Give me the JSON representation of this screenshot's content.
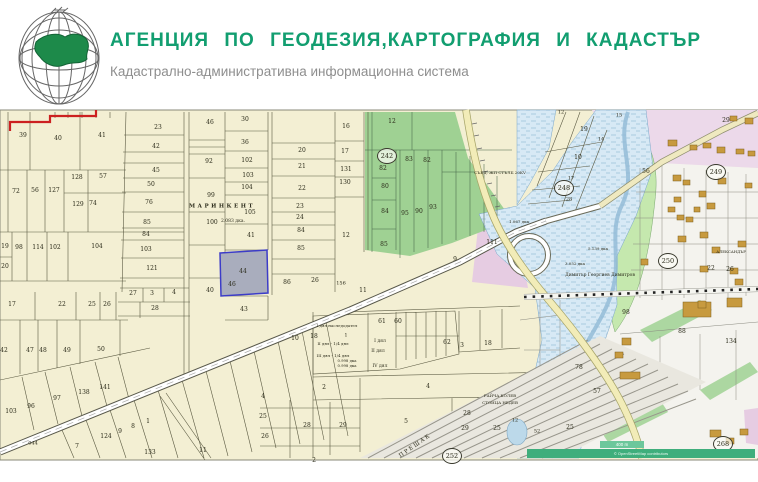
{
  "header": {
    "title": "АГЕНЦИЯ ПО ГЕОДЕЗИЯ,КАРТОГРАФИЯ И КАДАСТЪР",
    "subtitle": "Кадастрално-административна информационна система"
  },
  "map": {
    "highlighted_parcel": {
      "label": "44"
    },
    "sheets": [
      {
        "label": "242",
        "x": 387,
        "y": 156
      },
      {
        "label": "248",
        "x": 564,
        "y": 188
      },
      {
        "label": "249",
        "x": 716,
        "y": 172
      },
      {
        "label": "250",
        "x": 668,
        "y": 261
      },
      {
        "label": "252",
        "x": 452,
        "y": 456
      },
      {
        "label": "268",
        "x": 723,
        "y": 444
      }
    ],
    "attribution": {
      "scale": "400 m",
      "text": "© OpenStreetMap contributors"
    },
    "colors": {
      "brand_green": "#129e70",
      "parcel_fill": "#f3efd3",
      "zone_green": "#9fd193",
      "river_blue": "#d7e9f5",
      "road_yellow": "#f2ecb8",
      "highlight_fill": "#a9adbd",
      "highlight_border": "#3c3cc8",
      "red_boundary": "#cc2020",
      "attribution_teal": "#3fae7c"
    },
    "labels": [
      {
        "t": "39",
        "x": 23,
        "y": 136
      },
      {
        "t": "40",
        "x": 58,
        "y": 139
      },
      {
        "t": "41",
        "x": 102,
        "y": 136
      },
      {
        "t": "72",
        "x": 16,
        "y": 192
      },
      {
        "t": "56",
        "x": 35,
        "y": 191
      },
      {
        "t": "127",
        "x": 54,
        "y": 191
      },
      {
        "t": "128",
        "x": 77,
        "y": 178
      },
      {
        "t": "57",
        "x": 103,
        "y": 177
      },
      {
        "t": "129",
        "x": 78,
        "y": 205
      },
      {
        "t": "74",
        "x": 93,
        "y": 204
      },
      {
        "t": "19",
        "x": 5,
        "y": 247
      },
      {
        "t": "98",
        "x": 19,
        "y": 248
      },
      {
        "t": "114",
        "x": 38,
        "y": 248
      },
      {
        "t": "102",
        "x": 55,
        "y": 248
      },
      {
        "t": "104",
        "x": 97,
        "y": 247
      },
      {
        "t": "20",
        "x": 5,
        "y": 267
      },
      {
        "t": "17",
        "x": 12,
        "y": 305
      },
      {
        "t": "22",
        "x": 62,
        "y": 305
      },
      {
        "t": "25",
        "x": 92,
        "y": 305
      },
      {
        "t": "26",
        "x": 107,
        "y": 305
      },
      {
        "t": "42",
        "x": 4,
        "y": 351
      },
      {
        "t": "47",
        "x": 30,
        "y": 351
      },
      {
        "t": "48",
        "x": 43,
        "y": 351
      },
      {
        "t": "49",
        "x": 67,
        "y": 351
      },
      {
        "t": "50",
        "x": 101,
        "y": 350
      },
      {
        "t": "103",
        "x": 11,
        "y": 412
      },
      {
        "t": "96",
        "x": 31,
        "y": 407
      },
      {
        "t": "97",
        "x": 57,
        "y": 399
      },
      {
        "t": "138",
        "x": 84,
        "y": 393
      },
      {
        "t": "141",
        "x": 105,
        "y": 388
      },
      {
        "t": "7",
        "x": 77,
        "y": 447
      },
      {
        "t": "044",
        "x": 33,
        "y": 444,
        "s": 5
      },
      {
        "t": "23",
        "x": 158,
        "y": 128
      },
      {
        "t": "42",
        "x": 156,
        "y": 147
      },
      {
        "t": "45",
        "x": 156,
        "y": 171
      },
      {
        "t": "50",
        "x": 151,
        "y": 185
      },
      {
        "t": "76",
        "x": 149,
        "y": 203
      },
      {
        "t": "85",
        "x": 147,
        "y": 223
      },
      {
        "t": "84",
        "x": 146,
        "y": 235
      },
      {
        "t": "103",
        "x": 146,
        "y": 250
      },
      {
        "t": "121",
        "x": 152,
        "y": 269
      },
      {
        "t": "27",
        "x": 133,
        "y": 294
      },
      {
        "t": "3",
        "x": 152,
        "y": 294
      },
      {
        "t": "4",
        "x": 174,
        "y": 293
      },
      {
        "t": "28",
        "x": 155,
        "y": 309
      },
      {
        "t": "46",
        "x": 210,
        "y": 123
      },
      {
        "t": "92",
        "x": 209,
        "y": 162
      },
      {
        "t": "99",
        "x": 211,
        "y": 196
      },
      {
        "t": "100",
        "x": 212,
        "y": 223
      },
      {
        "t": "40",
        "x": 210,
        "y": 291
      },
      {
        "t": "30",
        "x": 245,
        "y": 120
      },
      {
        "t": "36",
        "x": 245,
        "y": 143
      },
      {
        "t": "102",
        "x": 247,
        "y": 161
      },
      {
        "t": "103",
        "x": 248,
        "y": 176
      },
      {
        "t": "104",
        "x": 247,
        "y": 188
      },
      {
        "t": "МАРИНКЕНТ",
        "x": 222,
        "y": 207,
        "s": 5.5,
        "ls": 2.5,
        "b": true
      },
      {
        "t": "105",
        "x": 250,
        "y": 213
      },
      {
        "t": "2.083 дка.",
        "x": 233,
        "y": 222,
        "s": 4.5
      },
      {
        "t": "41",
        "x": 251,
        "y": 236
      },
      {
        "t": "44",
        "x": 243,
        "y": 272
      },
      {
        "t": "43",
        "x": 244,
        "y": 310
      },
      {
        "t": "46",
        "x": 232,
        "y": 285
      },
      {
        "t": "20",
        "x": 302,
        "y": 151
      },
      {
        "t": "21",
        "x": 302,
        "y": 167
      },
      {
        "t": "22",
        "x": 302,
        "y": 189
      },
      {
        "t": "23",
        "x": 300,
        "y": 207
      },
      {
        "t": "24",
        "x": 300,
        "y": 218
      },
      {
        "t": "84",
        "x": 301,
        "y": 231
      },
      {
        "t": "85",
        "x": 301,
        "y": 249
      },
      {
        "t": "86",
        "x": 287,
        "y": 283
      },
      {
        "t": "26",
        "x": 315,
        "y": 281
      },
      {
        "t": "16",
        "x": 346,
        "y": 127
      },
      {
        "t": "17",
        "x": 345,
        "y": 152
      },
      {
        "t": "131",
        "x": 346,
        "y": 170
      },
      {
        "t": "130",
        "x": 345,
        "y": 183
      },
      {
        "t": "12",
        "x": 346,
        "y": 236
      },
      {
        "t": "156",
        "x": 341,
        "y": 284,
        "s": 5
      },
      {
        "t": "11",
        "x": 363,
        "y": 291
      },
      {
        "t": "12",
        "x": 392,
        "y": 122
      },
      {
        "t": "83",
        "x": 409,
        "y": 160
      },
      {
        "t": "82",
        "x": 427,
        "y": 161
      },
      {
        "t": "82",
        "x": 383,
        "y": 169
      },
      {
        "t": "80",
        "x": 385,
        "y": 187
      },
      {
        "t": "84",
        "x": 385,
        "y": 212
      },
      {
        "t": "85",
        "x": 384,
        "y": 245
      },
      {
        "t": "95",
        "x": 405,
        "y": 214
      },
      {
        "t": "90",
        "x": 419,
        "y": 212
      },
      {
        "t": "93",
        "x": 433,
        "y": 208
      },
      {
        "t": "12",
        "x": 561,
        "y": 113,
        "s": 5
      },
      {
        "t": "15",
        "x": 619,
        "y": 116,
        "s": 5
      },
      {
        "t": "19",
        "x": 584,
        "y": 130
      },
      {
        "t": "14",
        "x": 601,
        "y": 140,
        "s": 5
      },
      {
        "t": "10",
        "x": 578,
        "y": 158
      },
      {
        "t": "17",
        "x": 571,
        "y": 179,
        "s": 5
      },
      {
        "t": "28",
        "x": 569,
        "y": 200,
        "s": 5
      },
      {
        "t": "29",
        "x": 726,
        "y": 121
      },
      {
        "t": "56",
        "x": 646,
        "y": 172
      },
      {
        "t": "СЪЕД. ЖП СТЪЛБ 20КV",
        "x": 500,
        "y": 173,
        "s": 4
      },
      {
        "t": "111",
        "x": 492,
        "y": 243
      },
      {
        "t": "9",
        "x": 455,
        "y": 260
      },
      {
        "t": "1.067 дка",
        "x": 519,
        "y": 222,
        "s": 4
      },
      {
        "t": "5.139 дка",
        "x": 598,
        "y": 249,
        "s": 4
      },
      {
        "t": "3.052 дка",
        "x": 575,
        "y": 264,
        "s": 4
      },
      {
        "t": "Димитър Георгиев Димитров",
        "x": 600,
        "y": 276,
        "s": 4.5
      },
      {
        "t": "22",
        "x": 711,
        "y": 269
      },
      {
        "t": "26",
        "x": 730,
        "y": 270
      },
      {
        "t": "АЛЕКСАНДЪР",
        "x": 731,
        "y": 252,
        "s": 3.8
      },
      {
        "t": "98",
        "x": 626,
        "y": 313
      },
      {
        "t": "88",
        "x": 682,
        "y": 332
      },
      {
        "t": "134",
        "x": 731,
        "y": 342
      },
      {
        "t": "78",
        "x": 579,
        "y": 368
      },
      {
        "t": "57",
        "x": 597,
        "y": 392
      },
      {
        "t": "61",
        "x": 382,
        "y": 322
      },
      {
        "t": "60",
        "x": 398,
        "y": 322
      },
      {
        "t": "I дял наследодател",
        "x": 337,
        "y": 326,
        "s": 4
      },
      {
        "t": "1",
        "x": 346,
        "y": 336,
        "s": 5
      },
      {
        "t": "II дял - 1/4 дял",
        "x": 333,
        "y": 344,
        "s": 4
      },
      {
        "t": "III дял - 1/4 дял",
        "x": 333,
        "y": 356,
        "s": 4
      },
      {
        "t": "0.998 дка",
        "x": 347,
        "y": 361,
        "s": 3.8
      },
      {
        "t": "0.998 дка",
        "x": 347,
        "y": 366,
        "s": 3.8
      },
      {
        "t": "I дял",
        "x": 380,
        "y": 342,
        "s": 4.5
      },
      {
        "t": "II дял",
        "x": 378,
        "y": 352,
        "s": 4.5
      },
      {
        "t": "IV дял",
        "x": 380,
        "y": 367,
        "s": 4.5
      },
      {
        "t": "62",
        "x": 447,
        "y": 343
      },
      {
        "t": "3",
        "x": 462,
        "y": 346
      },
      {
        "t": "18",
        "x": 488,
        "y": 344
      },
      {
        "t": "10",
        "x": 295,
        "y": 339
      },
      {
        "t": "18",
        "x": 314,
        "y": 337
      },
      {
        "t": "4",
        "x": 428,
        "y": 387
      },
      {
        "t": "5",
        "x": 406,
        "y": 422
      },
      {
        "t": "2",
        "x": 324,
        "y": 388
      },
      {
        "t": "4",
        "x": 263,
        "y": 397
      },
      {
        "t": "25",
        "x": 263,
        "y": 417
      },
      {
        "t": "26",
        "x": 265,
        "y": 437
      },
      {
        "t": "28",
        "x": 307,
        "y": 426
      },
      {
        "t": "29",
        "x": 343,
        "y": 426
      },
      {
        "t": "28",
        "x": 467,
        "y": 414
      },
      {
        "t": "29",
        "x": 465,
        "y": 429
      },
      {
        "t": "2",
        "x": 314,
        "y": 461
      },
      {
        "t": "25",
        "x": 497,
        "y": 429
      },
      {
        "t": "12",
        "x": 515,
        "y": 421,
        "s": 5
      },
      {
        "t": "52",
        "x": 537,
        "y": 432,
        "s": 5
      },
      {
        "t": "П Р Е Ш А К",
        "x": 415,
        "y": 447,
        "r": -35,
        "s": 5.5
      },
      {
        "t": "РАЙЧА КОЛЕВ",
        "x": 500,
        "y": 396,
        "s": 4
      },
      {
        "t": "СТОИЦА НЕДЕВ",
        "x": 500,
        "y": 403,
        "s": 4
      },
      {
        "t": "25",
        "x": 570,
        "y": 428
      },
      {
        "t": "124",
        "x": 106,
        "y": 437
      },
      {
        "t": "9",
        "x": 120,
        "y": 432
      },
      {
        "t": "8",
        "x": 133,
        "y": 427
      },
      {
        "t": "1",
        "x": 148,
        "y": 422
      },
      {
        "t": "133",
        "x": 150,
        "y": 453
      },
      {
        "t": "11",
        "x": 203,
        "y": 451
      }
    ]
  }
}
